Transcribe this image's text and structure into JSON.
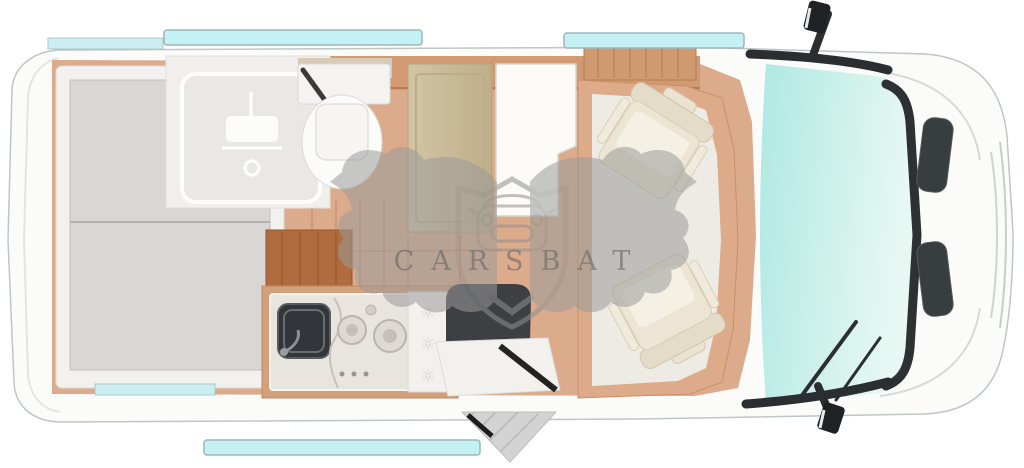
{
  "watermark": {
    "text": "CARSBAT",
    "logo_icon": "bat-wings-shield-car-icon"
  },
  "kitchen": {
    "snowflake_glyph": "✳"
  },
  "palette": {
    "body_white": "#fbfbfa",
    "outline_gray": "#c0c5c6",
    "floor_wood": "#dcab8b",
    "wood_dark_band": "#d29a72",
    "cabinet_wood_dark": "#b06c3e",
    "overhead_cabinet_wood": "#d09a70",
    "bed_gray": "#d8d7d4",
    "bed_frame_white": "#f2f1ef",
    "bathroom_floor": "#f0efec",
    "wardrobe_khaki": "#cabb98",
    "table_white": "#fcfbf8",
    "counter_steel": "#e8e4de",
    "sink_dark": "#323539",
    "fridge_white": "#f3f1ed",
    "bench_dark": "#3e3f42",
    "seat_cream": "#ece5d3",
    "cab_floor_white": "#edebe4",
    "windshield_teal": "#b0e9e4",
    "windshield_fade": "#e4f6f1",
    "window_strip_cyan": "#c4f1f3",
    "trim_black": "#2b2e30",
    "step_gray": "#d3d3d3",
    "watermark_gray": "#9b9b9b"
  }
}
